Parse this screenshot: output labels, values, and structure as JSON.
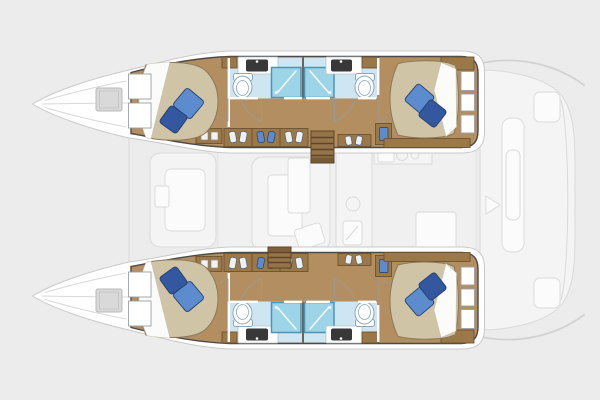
{
  "meta": {
    "description": "Top-down interior layout plan of a 4-cabin sailing catamaran; bow pointing left, two symmetric hulls with cabins and bathrooms, ghosted saloon, foredeck and aft cockpit"
  },
  "colors": {
    "bg": "#ececec",
    "hull_fill": "#ffffff",
    "hull_stroke": "#4a4a4a",
    "ghost_fill": "#f4f4f4",
    "ghost_stroke": "#dadada",
    "wood_floor": "#b28e60",
    "wood_cab": "#9b7848",
    "wood_cab_edge": "#6e5230",
    "stair_wood": "#96744a",
    "stair_tread": "#5e4527",
    "bed_fill": "#d0c4a7",
    "bed_stroke": "#8a795a",
    "sheet_fill": "#fbfbf9",
    "pillow_light": "#5c8cce",
    "pillow_dark": "#33589f",
    "pillow_edge": "#23406e",
    "bath_floor": "#cde6f2",
    "shower_fill": "#9ed4e8",
    "shower_stroke": "#4e93b4",
    "fixture_stroke": "#8aa8ba",
    "sink_dark": "#383838",
    "counter_fill": "#fdfdfd",
    "counter_stroke": "#b9c2c8",
    "door_stroke": "#9a9a9a",
    "hatch_fill": "#d9d9d9",
    "hatch_stroke": "#b9b9b9",
    "wall_white": "#ffffff"
  },
  "features": {
    "port_hull": {
      "position": "top",
      "rooms": [
        "forward-cabin",
        "forward-bathroom",
        "wardrobe",
        "companionway-stairs",
        "aft-bathroom",
        "aft-cabin"
      ]
    },
    "starboard_hull": {
      "position": "bottom",
      "rooms": [
        "forward-cabin",
        "forward-bathroom",
        "wardrobe",
        "companionway-stairs",
        "aft-bathroom",
        "aft-cabin"
      ]
    },
    "bridgedeck": {
      "state": "ghosted",
      "elements": [
        "forward-cockpit-seat",
        "saloon-seating",
        "saloon-table",
        "galley-counter",
        "galley-round-sink",
        "galley-sink",
        "cooktop"
      ]
    },
    "exterior": {
      "state": "ghosted",
      "elements": [
        "bow-trampoline",
        "deck-hatch",
        "aft-cockpit",
        "cockpit-table",
        "cockpit-bench",
        "transom-steps",
        "hardtop-outline"
      ]
    },
    "counts": {
      "cabins": 4,
      "bathrooms": 4,
      "double_berths": 4,
      "pillows_per_berth": 2,
      "showers": 4,
      "toilets": 4,
      "sinks": 4
    }
  }
}
